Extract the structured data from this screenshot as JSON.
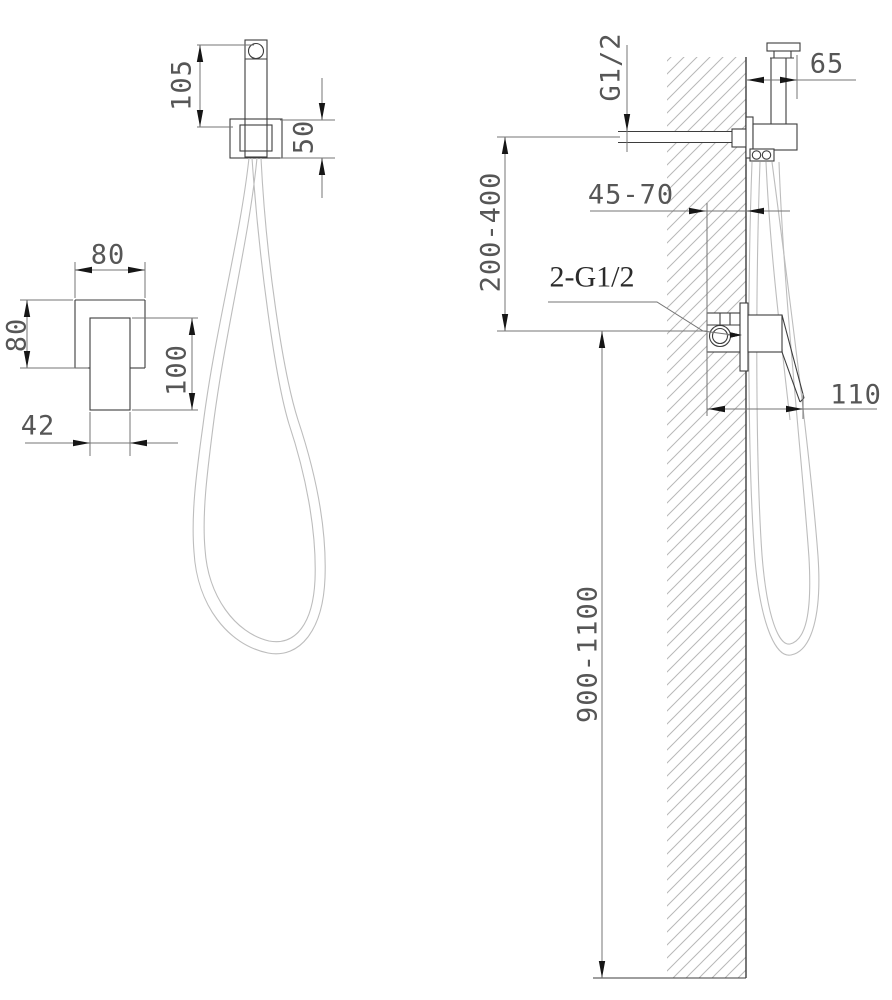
{
  "front_view": {
    "sprayer_height": "105",
    "holder_height": "50",
    "plate_width": "80",
    "plate_height": "80",
    "handle_length": "100",
    "handle_width": "42"
  },
  "side_view": {
    "supply_thread": "G1/2",
    "sprayer_wall_offset": "65",
    "concealed_depth": "45-70",
    "supply_to_valve_height": "200-400",
    "valve_connections": "2-G1/2",
    "valve_projection": "110",
    "mounting_height": "900-1100"
  },
  "colors": {
    "outline": "#3d3d3d",
    "dimension_line": "#747474",
    "arrow": "#161616",
    "dim_text": "#565656",
    "hatch": "#b8b8b8",
    "hose": "#bdbdbd",
    "background": "#ffffff"
  }
}
